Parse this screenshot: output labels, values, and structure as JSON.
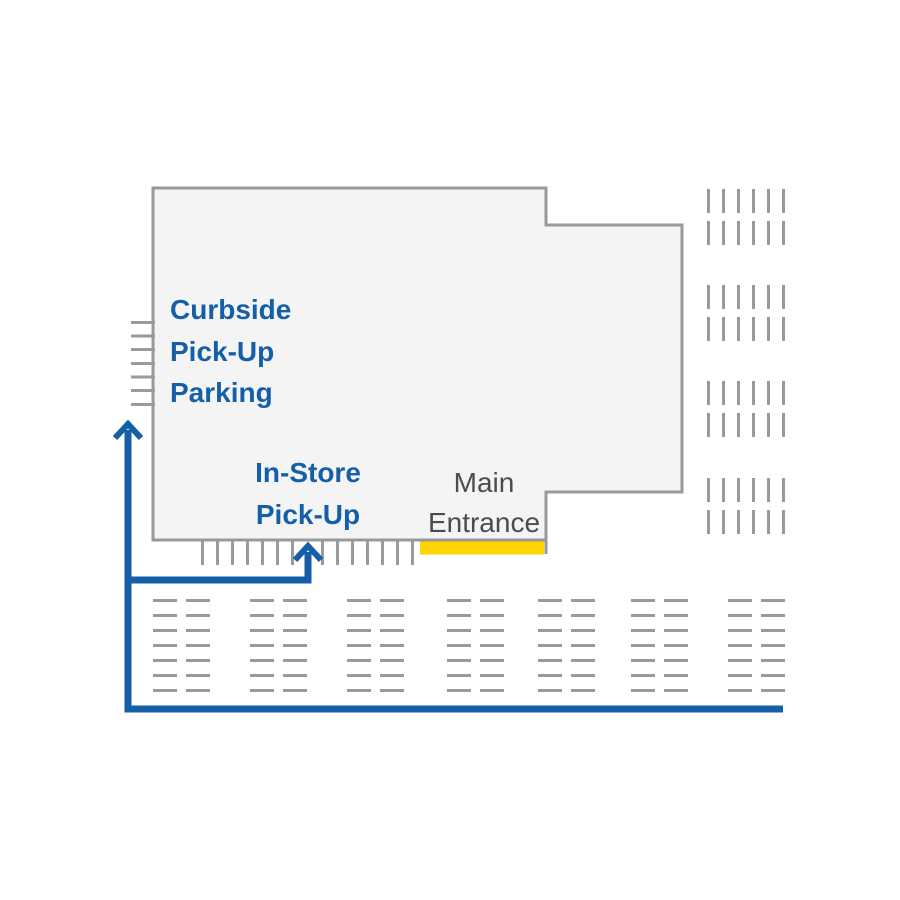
{
  "labels": {
    "curbside_parking": {
      "lines": [
        "Curbside",
        "Pick-Up",
        "Parking"
      ]
    },
    "in_store_pickup": {
      "lines": [
        "In-Store",
        "Pick-Up"
      ]
    },
    "main_entrance": {
      "lines": [
        "Main",
        "Entrance"
      ]
    }
  },
  "colors": {
    "route_blue": "#155fa8",
    "label_blue": "#155fa8",
    "entrance_yellow": "#ffd500",
    "building_fill": "#f4f4f4",
    "building_outline": "#999999",
    "marking_gray": "#9a9a9a",
    "entrance_text_gray": "#4c4c4c",
    "background": "#ffffff"
  },
  "geometry": {
    "canvas": {
      "width": 900,
      "height": 900
    },
    "building": {
      "outline_path": "M153,188 L546,188 L546,225 L682,225 L682,492 L546,492 L546,540 L153,540 Z",
      "outline_width": 3,
      "entrance_step_line": {
        "x": 546,
        "y1": 538,
        "y2": 554
      }
    },
    "entrance_bar": {
      "x": 420,
      "y": 541.5,
      "w": 124,
      "h": 13
    },
    "parking": {
      "curbside_spaces": {
        "x": 131,
        "length": 24,
        "thickness": 3,
        "ys": [
          321,
          334.5,
          348,
          362,
          375.5,
          389,
          403
        ]
      },
      "in_store_ticks": {
        "y": 541,
        "length": 24,
        "thickness": 3,
        "xs": [
          201,
          216,
          231,
          246,
          261,
          276,
          291,
          321,
          336,
          351,
          366,
          381,
          396,
          411
        ]
      },
      "right_lot": {
        "dash_length": 24,
        "thickness": 3,
        "xs": [
          707,
          722,
          737,
          752,
          767,
          782
        ],
        "row_tops": [
          189,
          221,
          285,
          317,
          381,
          413,
          478,
          510
        ]
      },
      "bottom_lot": {
        "dash_length": 24,
        "thickness": 3,
        "col_lefts": [
          153,
          186,
          250,
          283,
          347,
          380,
          447,
          480,
          538,
          571,
          631,
          664,
          728,
          761
        ],
        "row_tops": [
          599,
          614,
          629,
          644,
          659,
          674,
          689
        ]
      }
    },
    "route": {
      "stroke_width": 7,
      "arrow_stroke_width": 6,
      "main_line_points": "783,709 128,709 128,430",
      "main_arrow_path": "M115,438 L128,424 L141,438",
      "branch_line_points": "125,580 308,580 308,552",
      "branch_arrow_path": "M295,560 L308,546 L321,560"
    }
  }
}
